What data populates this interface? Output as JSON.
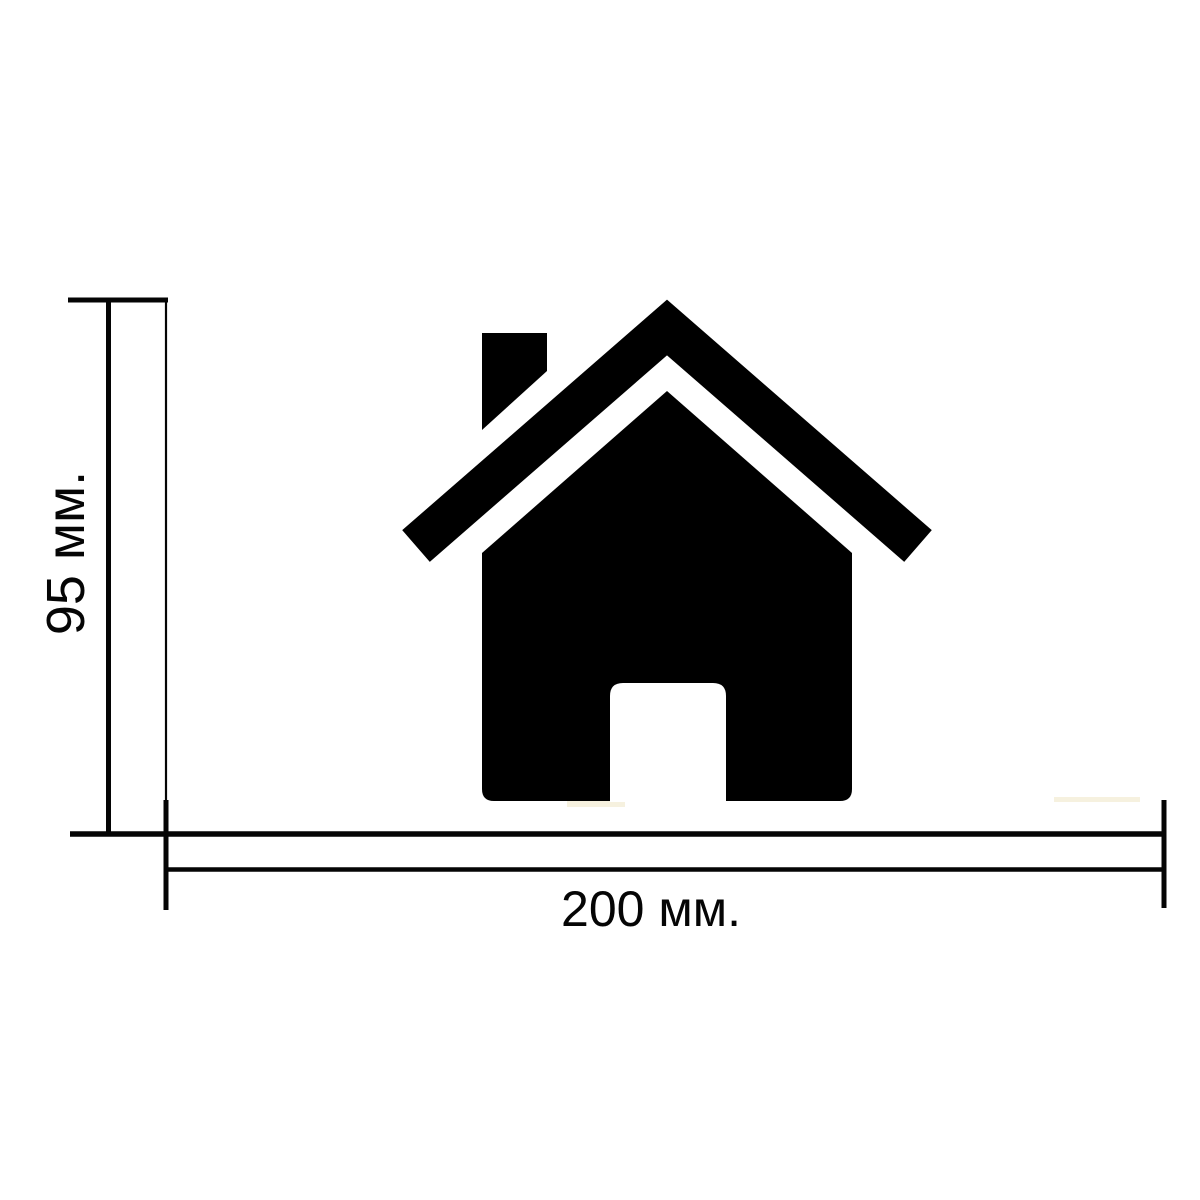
{
  "diagram": {
    "background_color": "#ffffff",
    "line_color": "#050505",
    "icon": {
      "name": "home-icon",
      "color": "#000000"
    },
    "height_dimension": {
      "label": "95 мм.",
      "value": 95,
      "unit": "мм"
    },
    "width_dimension": {
      "label": "200 мм.",
      "value": 200,
      "unit": "мм"
    },
    "artifact_color": "#f5efd9"
  }
}
